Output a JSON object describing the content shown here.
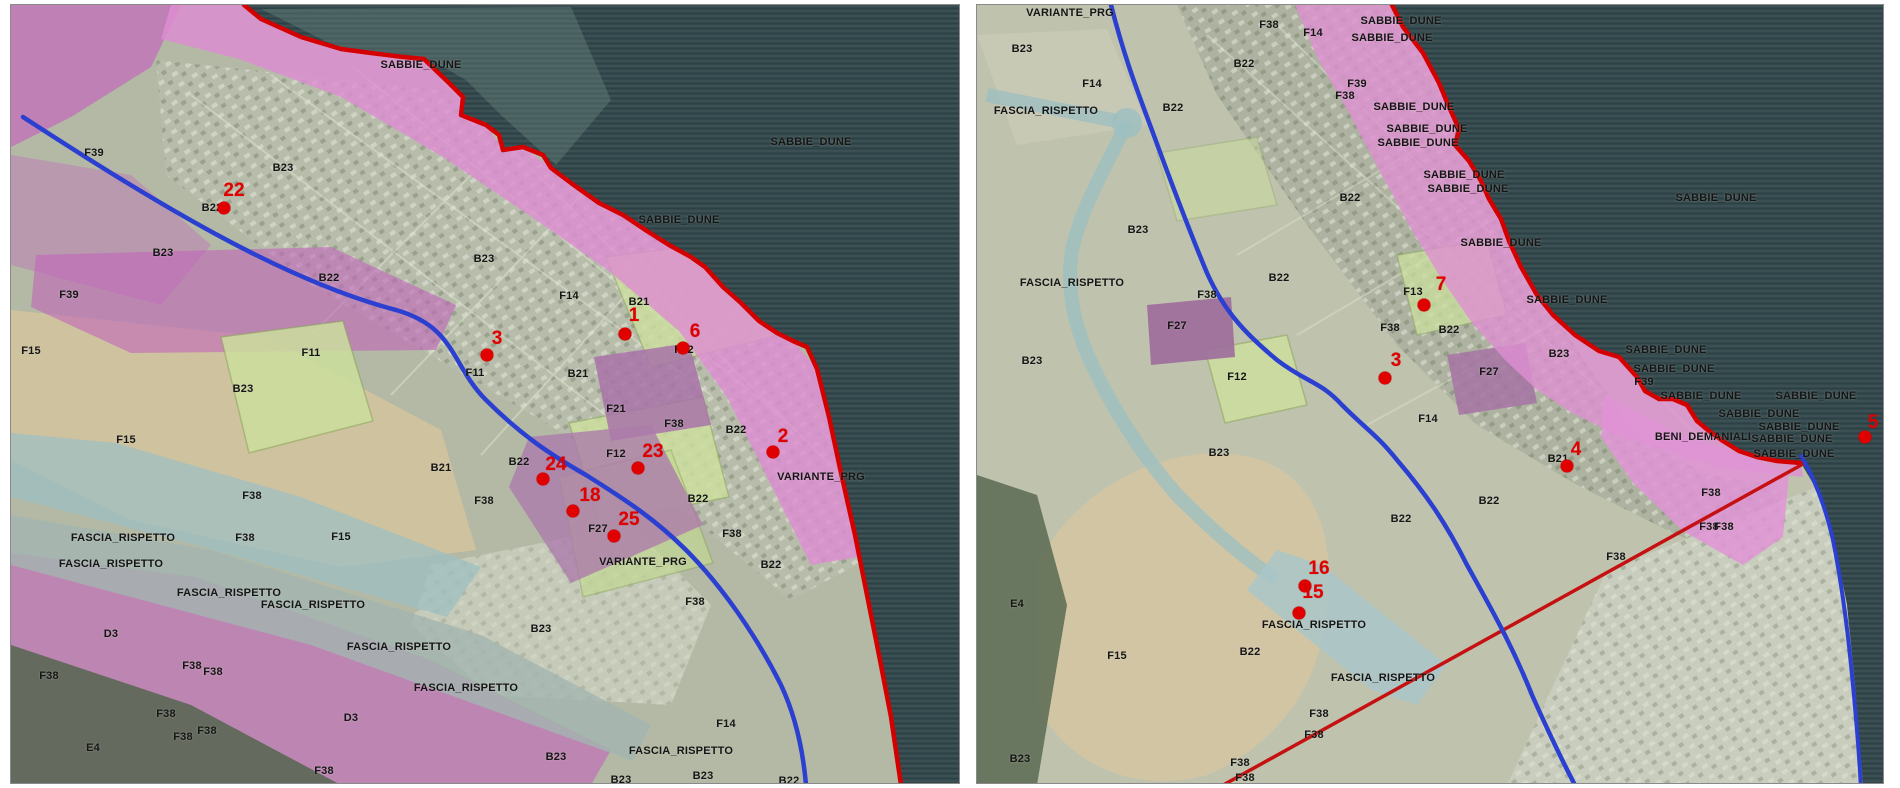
{
  "document": {
    "title": "PRG zoning aerial map comparison",
    "panel_count": 2
  },
  "colors": {
    "sea": "#33484c",
    "dune_pink": "#de8ed2",
    "magenta_zone": "#c468bc",
    "purple_zone": "#9d6b9c",
    "pale_green_zone": "#ccdf9e",
    "teal_channel": "#9dbfc1",
    "tan_field": "#cfc29f",
    "coast_red": "#d40000",
    "road_blue": "#2b3fd0",
    "boundary_red": "#c51111",
    "marker_red": "#e10000",
    "label_black": "#151515"
  },
  "panels": [
    {
      "name": "left-map",
      "labels": [
        {
          "t": "SABBIE_DUNE",
          "x": 410,
          "y": 60
        },
        {
          "t": "SABBIE_DUNE",
          "x": 668,
          "y": 215
        },
        {
          "t": "SABBIE_DUNE",
          "x": 800,
          "y": 137
        },
        {
          "t": "F39",
          "x": 83,
          "y": 148
        },
        {
          "t": "B23",
          "x": 272,
          "y": 163
        },
        {
          "t": "B22",
          "x": 201,
          "y": 203
        },
        {
          "t": "B23",
          "x": 152,
          "y": 248
        },
        {
          "t": "F39",
          "x": 58,
          "y": 290
        },
        {
          "t": "B22",
          "x": 318,
          "y": 273
        },
        {
          "t": "F15",
          "x": 20,
          "y": 346
        },
        {
          "t": "B23",
          "x": 232,
          "y": 384
        },
        {
          "t": "F11",
          "x": 300,
          "y": 348
        },
        {
          "t": "F11",
          "x": 464,
          "y": 368
        },
        {
          "t": "B23",
          "x": 473,
          "y": 254
        },
        {
          "t": "F14",
          "x": 558,
          "y": 291
        },
        {
          "t": "B21",
          "x": 628,
          "y": 297
        },
        {
          "t": "B21",
          "x": 567,
          "y": 369
        },
        {
          "t": "F21",
          "x": 605,
          "y": 404
        },
        {
          "t": "F38",
          "x": 663,
          "y": 419
        },
        {
          "t": "B22",
          "x": 725,
          "y": 425
        },
        {
          "t": "F12",
          "x": 673,
          "y": 345
        },
        {
          "t": "F12",
          "x": 605,
          "y": 449
        },
        {
          "t": "B21",
          "x": 430,
          "y": 463
        },
        {
          "t": "B22",
          "x": 508,
          "y": 457
        },
        {
          "t": "F38",
          "x": 473,
          "y": 496
        },
        {
          "t": "F27",
          "x": 587,
          "y": 524
        },
        {
          "t": "VARIANTE_PRG",
          "x": 632,
          "y": 557
        },
        {
          "t": "VARIANTE_PRG",
          "x": 810,
          "y": 472
        },
        {
          "t": "B22",
          "x": 687,
          "y": 494
        },
        {
          "t": "F38",
          "x": 721,
          "y": 529
        },
        {
          "t": "B22",
          "x": 760,
          "y": 560
        },
        {
          "t": "F38",
          "x": 684,
          "y": 597
        },
        {
          "t": "B23",
          "x": 530,
          "y": 624
        },
        {
          "t": "FASCIA_RISPETTO",
          "x": 388,
          "y": 642
        },
        {
          "t": "FASCIA_RISPETTO",
          "x": 455,
          "y": 683
        },
        {
          "t": "B23",
          "x": 545,
          "y": 752
        },
        {
          "t": "FASCIA_RISPETTO",
          "x": 670,
          "y": 746
        },
        {
          "t": "F14",
          "x": 715,
          "y": 719
        },
        {
          "t": "B23",
          "x": 692,
          "y": 771
        },
        {
          "t": "B23",
          "x": 610,
          "y": 775
        },
        {
          "t": "B22",
          "x": 778,
          "y": 776
        },
        {
          "t": "F15",
          "x": 115,
          "y": 435
        },
        {
          "t": "F38",
          "x": 241,
          "y": 491
        },
        {
          "t": "FASCIA_RISPETTO",
          "x": 112,
          "y": 533
        },
        {
          "t": "F38",
          "x": 234,
          "y": 533
        },
        {
          "t": "F15",
          "x": 330,
          "y": 532
        },
        {
          "t": "FASCIA_RISPETTO",
          "x": 100,
          "y": 559
        },
        {
          "t": "FASCIA_RISPETTO",
          "x": 218,
          "y": 588
        },
        {
          "t": "FASCIA_RISPETTO",
          "x": 302,
          "y": 600
        },
        {
          "t": "D3",
          "x": 100,
          "y": 629
        },
        {
          "t": "F38",
          "x": 38,
          "y": 671
        },
        {
          "t": "F38",
          "x": 181,
          "y": 661
        },
        {
          "t": "F38",
          "x": 202,
          "y": 667
        },
        {
          "t": "F38",
          "x": 155,
          "y": 709
        },
        {
          "t": "F38",
          "x": 196,
          "y": 726
        },
        {
          "t": "F38",
          "x": 172,
          "y": 732
        },
        {
          "t": "E4",
          "x": 82,
          "y": 743
        },
        {
          "t": "D3",
          "x": 340,
          "y": 713
        },
        {
          "t": "F38",
          "x": 313,
          "y": 766
        }
      ],
      "points": [
        {
          "n": "22",
          "nx": 223,
          "ny": 186,
          "dx": 213,
          "dy": 203
        },
        {
          "n": "1",
          "nx": 623,
          "ny": 311,
          "dx": 614,
          "dy": 329
        },
        {
          "n": "3",
          "nx": 486,
          "ny": 334,
          "dx": 476,
          "dy": 350
        },
        {
          "n": "6",
          "nx": 684,
          "ny": 327,
          "dx": 672,
          "dy": 343
        },
        {
          "n": "23",
          "nx": 642,
          "ny": 447,
          "dx": 627,
          "dy": 463
        },
        {
          "n": "2",
          "nx": 772,
          "ny": 432,
          "dx": 762,
          "dy": 447
        },
        {
          "n": "24",
          "nx": 545,
          "ny": 460,
          "dx": 532,
          "dy": 474
        },
        {
          "n": "18",
          "nx": 579,
          "ny": 491,
          "dx": 562,
          "dy": 506
        },
        {
          "n": "25",
          "nx": 618,
          "ny": 515,
          "dx": 603,
          "dy": 531
        }
      ]
    },
    {
      "name": "right-map",
      "labels": [
        {
          "t": "VARIANTE_PRG",
          "x": 93,
          "y": 8
        },
        {
          "t": "B23",
          "x": 45,
          "y": 44
        },
        {
          "t": "F14",
          "x": 115,
          "y": 79
        },
        {
          "t": "FASCIA_RISPETTO",
          "x": 69,
          "y": 106
        },
        {
          "t": "B22",
          "x": 196,
          "y": 103
        },
        {
          "t": "F38",
          "x": 292,
          "y": 20
        },
        {
          "t": "F14",
          "x": 336,
          "y": 28
        },
        {
          "t": "SABBIE_DUNE",
          "x": 424,
          "y": 16
        },
        {
          "t": "SABBIE_DUNE",
          "x": 415,
          "y": 33
        },
        {
          "t": "B22",
          "x": 267,
          "y": 59
        },
        {
          "t": "F39",
          "x": 380,
          "y": 79
        },
        {
          "t": "F38",
          "x": 368,
          "y": 91
        },
        {
          "t": "SABBIE_DUNE",
          "x": 437,
          "y": 102
        },
        {
          "t": "SABBIE_DUNE",
          "x": 450,
          "y": 124
        },
        {
          "t": "SABBIE_DUNE",
          "x": 441,
          "y": 138
        },
        {
          "t": "SABBIE_DUNE",
          "x": 487,
          "y": 170
        },
        {
          "t": "SABBIE_DUNE",
          "x": 491,
          "y": 184
        },
        {
          "t": "B22",
          "x": 373,
          "y": 193
        },
        {
          "t": "SABBIE_DUNE",
          "x": 739,
          "y": 193
        },
        {
          "t": "SABBIE_DUNE",
          "x": 524,
          "y": 238
        },
        {
          "t": "B23",
          "x": 161,
          "y": 225
        },
        {
          "t": "FASCIA_RISPETTO",
          "x": 95,
          "y": 278
        },
        {
          "t": "F38",
          "x": 230,
          "y": 290
        },
        {
          "t": "F27",
          "x": 200,
          "y": 321
        },
        {
          "t": "B23",
          "x": 55,
          "y": 356
        },
        {
          "t": "B22",
          "x": 302,
          "y": 273
        },
        {
          "t": "F13",
          "x": 436,
          "y": 287
        },
        {
          "t": "F38",
          "x": 413,
          "y": 323
        },
        {
          "t": "B22",
          "x": 472,
          "y": 325
        },
        {
          "t": "F12",
          "x": 260,
          "y": 372
        },
        {
          "t": "F27",
          "x": 512,
          "y": 367
        },
        {
          "t": "B23",
          "x": 582,
          "y": 349
        },
        {
          "t": "SABBIE_DUNE",
          "x": 590,
          "y": 295
        },
        {
          "t": "SABBIE_DUNE",
          "x": 689,
          "y": 345
        },
        {
          "t": "SABBIE_DUNE",
          "x": 697,
          "y": 364
        },
        {
          "t": "F39",
          "x": 667,
          "y": 377
        },
        {
          "t": "SABBIE_DUNE",
          "x": 724,
          "y": 391
        },
        {
          "t": "SABBIE_DUNE",
          "x": 839,
          "y": 391
        },
        {
          "t": "SABBIE_DUNE",
          "x": 782,
          "y": 409
        },
        {
          "t": "SABBIE_DUNE",
          "x": 822,
          "y": 422
        },
        {
          "t": "BENI_DEMANIALI",
          "x": 726,
          "y": 432
        },
        {
          "t": "SABBIE_DUNE",
          "x": 815,
          "y": 434
        },
        {
          "t": "SABBIE_DUNE",
          "x": 817,
          "y": 449
        },
        {
          "t": "F14",
          "x": 451,
          "y": 414
        },
        {
          "t": "B21",
          "x": 581,
          "y": 454
        },
        {
          "t": "B22",
          "x": 424,
          "y": 514
        },
        {
          "t": "B22",
          "x": 512,
          "y": 496
        },
        {
          "t": "F38",
          "x": 734,
          "y": 488
        },
        {
          "t": "F38",
          "x": 732,
          "y": 522
        },
        {
          "t": "F38",
          "x": 747,
          "y": 522
        },
        {
          "t": "F38",
          "x": 639,
          "y": 552
        },
        {
          "t": "B23",
          "x": 242,
          "y": 448
        },
        {
          "t": "E4",
          "x": 40,
          "y": 599
        },
        {
          "t": "F15",
          "x": 140,
          "y": 651
        },
        {
          "t": "FASCIA_RISPETTO",
          "x": 337,
          "y": 620
        },
        {
          "t": "B22",
          "x": 273,
          "y": 647
        },
        {
          "t": "FASCIA_RISPETTO",
          "x": 406,
          "y": 673
        },
        {
          "t": "F38",
          "x": 342,
          "y": 709
        },
        {
          "t": "F38",
          "x": 337,
          "y": 730
        },
        {
          "t": "F38",
          "x": 263,
          "y": 758
        },
        {
          "t": "F38",
          "x": 268,
          "y": 773
        },
        {
          "t": "B23",
          "x": 43,
          "y": 754
        }
      ],
      "points": [
        {
          "n": "7",
          "nx": 464,
          "ny": 280,
          "dx": 447,
          "dy": 300
        },
        {
          "n": "3",
          "nx": 419,
          "ny": 356,
          "dx": 408,
          "dy": 373
        },
        {
          "n": "4",
          "nx": 599,
          "ny": 445,
          "dx": 590,
          "dy": 461
        },
        {
          "n": "5",
          "nx": 896,
          "ny": 418,
          "dx": 888,
          "dy": 432
        },
        {
          "n": "16",
          "nx": 342,
          "ny": 564,
          "dx": 328,
          "dy": 581
        },
        {
          "n": "15",
          "nx": 336,
          "ny": 588,
          "dx": 322,
          "dy": 608
        }
      ]
    }
  ]
}
